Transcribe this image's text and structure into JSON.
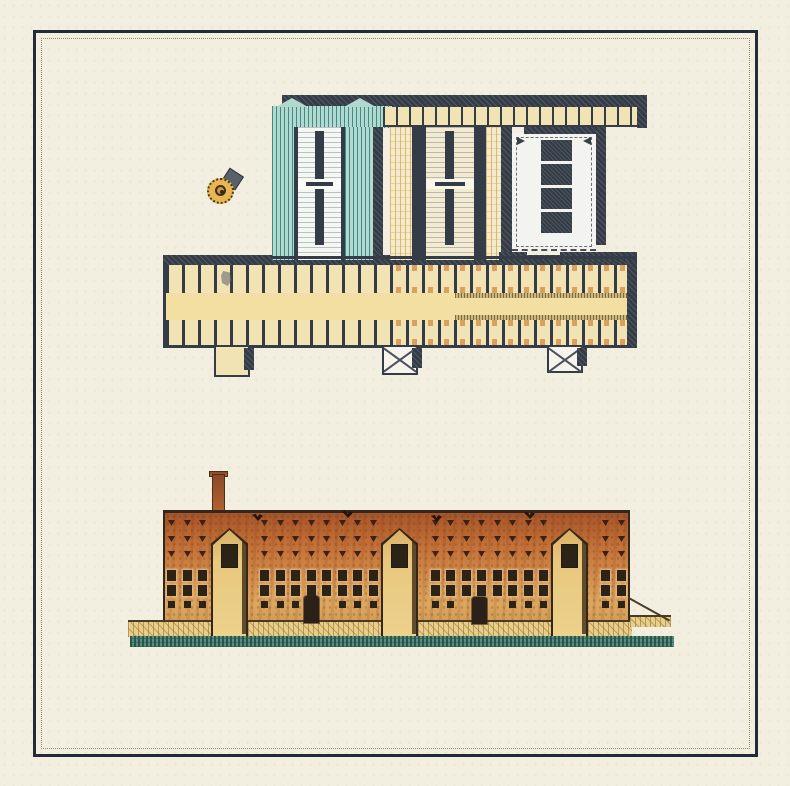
{
  "document": {
    "kind": "scanned architectural plate",
    "figures": [
      {
        "name": "ground-plan",
        "position": "upper half"
      },
      {
        "name": "front-elevation",
        "position": "lower half"
      }
    ],
    "visible_text": []
  },
  "palette": {
    "paper": "#f2efe0",
    "frame": "#222b38",
    "innerDotted": "#938a63",
    "wallDark": "#343c47",
    "wallHi": "rgba(255,255,255,0.14)",
    "teal": "#b2d8cf",
    "tealLine": "#3f8c83",
    "roomWhite": "#f5f7f2",
    "roomCream": "#f2ebd2",
    "stripe": "rgba(104,119,129,0.42)",
    "cream": "#f1e3b4",
    "corridor": "#f3dfa2",
    "corridorHatch": "#cdb87c",
    "corridorHatchLine": "#7c6a42",
    "capital": "#db9f5e",
    "towerTan": "#e9c87d",
    "towerShadow": "rgba(56,38,20,0.78)",
    "outline": "#33271c",
    "windowDark": "#2c2216",
    "windowFrame": "rgba(235,210,160,0.5)",
    "slit": "#3a2212",
    "base": "#eace87",
    "ground": "#5c8d7e",
    "groundLine": "#27584c",
    "metal": "#596069",
    "roundel": "#e8b652",
    "roundelRing": "#4a3a20",
    "roundelInner": "#d0944a"
  },
  "plan": {
    "column_stack": {
      "x": 541,
      "y": 140,
      "w": 31,
      "h": 21,
      "gap": 3,
      "count": 4
    },
    "stack_arrows": [
      {
        "x": 517,
        "y": 137,
        "dir": "right"
      },
      {
        "x": 583,
        "y": 137,
        "dir": "left"
      }
    ],
    "towers": [
      {
        "x": 214,
        "y": 347,
        "w": 36,
        "h": 30,
        "style": "open"
      },
      {
        "x": 382,
        "y": 347,
        "w": 36,
        "h": 28,
        "style": "cross"
      },
      {
        "x": 547,
        "y": 347,
        "w": 36,
        "h": 26,
        "style": "cross"
      }
    ]
  },
  "elevation": {
    "facade": {
      "x": 163,
      "y": 510,
      "w": 467,
      "h": 112
    },
    "towers": [
      {
        "x": 211
      },
      {
        "x": 381
      },
      {
        "x": 551
      }
    ],
    "tower_w": 37,
    "tower_top": 528,
    "tower_h": 110,
    "window_rows": [
      {
        "type": "slit",
        "y": 520
      },
      {
        "type": "slit",
        "y": 536
      },
      {
        "type": "slit",
        "y": 551
      },
      {
        "type": "framed",
        "y": 570
      },
      {
        "type": "framed",
        "y": 585
      },
      {
        "type": "square",
        "y": 601
      }
    ],
    "window_col_start": 171,
    "window_col_end": 621,
    "window_col_step": 15.5,
    "tower_skip": [
      [
        206,
        252
      ],
      [
        376,
        422
      ],
      [
        546,
        592
      ]
    ],
    "door_skip": [
      [
        297,
        328
      ],
      [
        465,
        498
      ]
    ],
    "doors": [
      {
        "x": 304,
        "y": 596,
        "w": 15,
        "h": 27
      },
      {
        "x": 472,
        "y": 597,
        "w": 15,
        "h": 27
      }
    ],
    "accent_marks": [
      {
        "x": 257,
        "y": 514
      },
      {
        "x": 347,
        "y": 511
      },
      {
        "x": 436,
        "y": 515
      },
      {
        "x": 529,
        "y": 512
      }
    ]
  }
}
